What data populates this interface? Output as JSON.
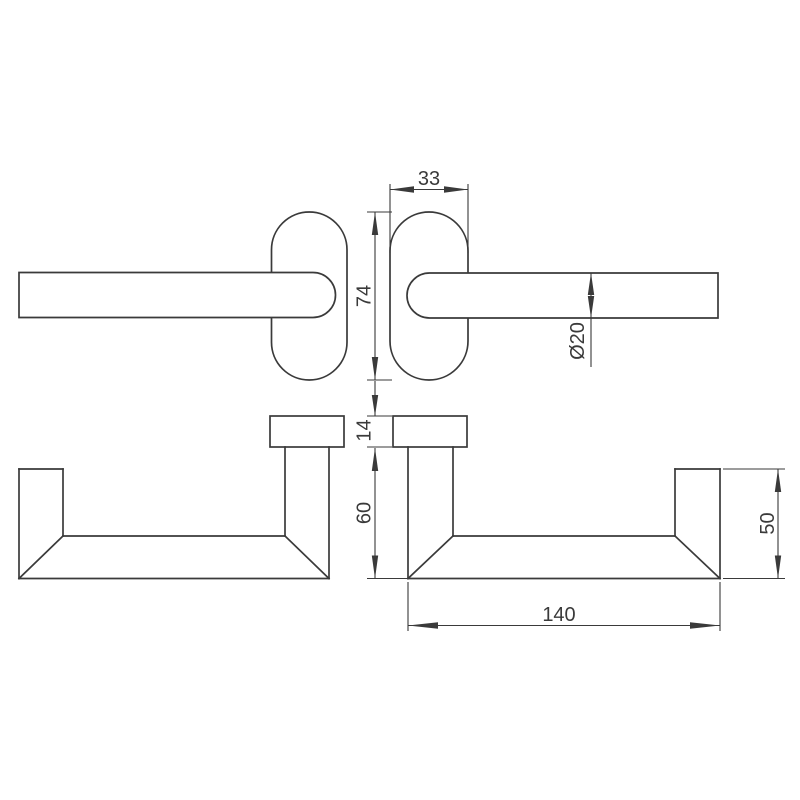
{
  "drawing": {
    "background_color": "#ffffff",
    "line_color": "#3a3a3a",
    "dimensions": {
      "rosette_width": "33",
      "rosette_height": "74",
      "bar_diameter": "Ø20",
      "plate_thickness": "14",
      "drop_height": "60",
      "post_height": "50",
      "rail_length": "140"
    }
  }
}
